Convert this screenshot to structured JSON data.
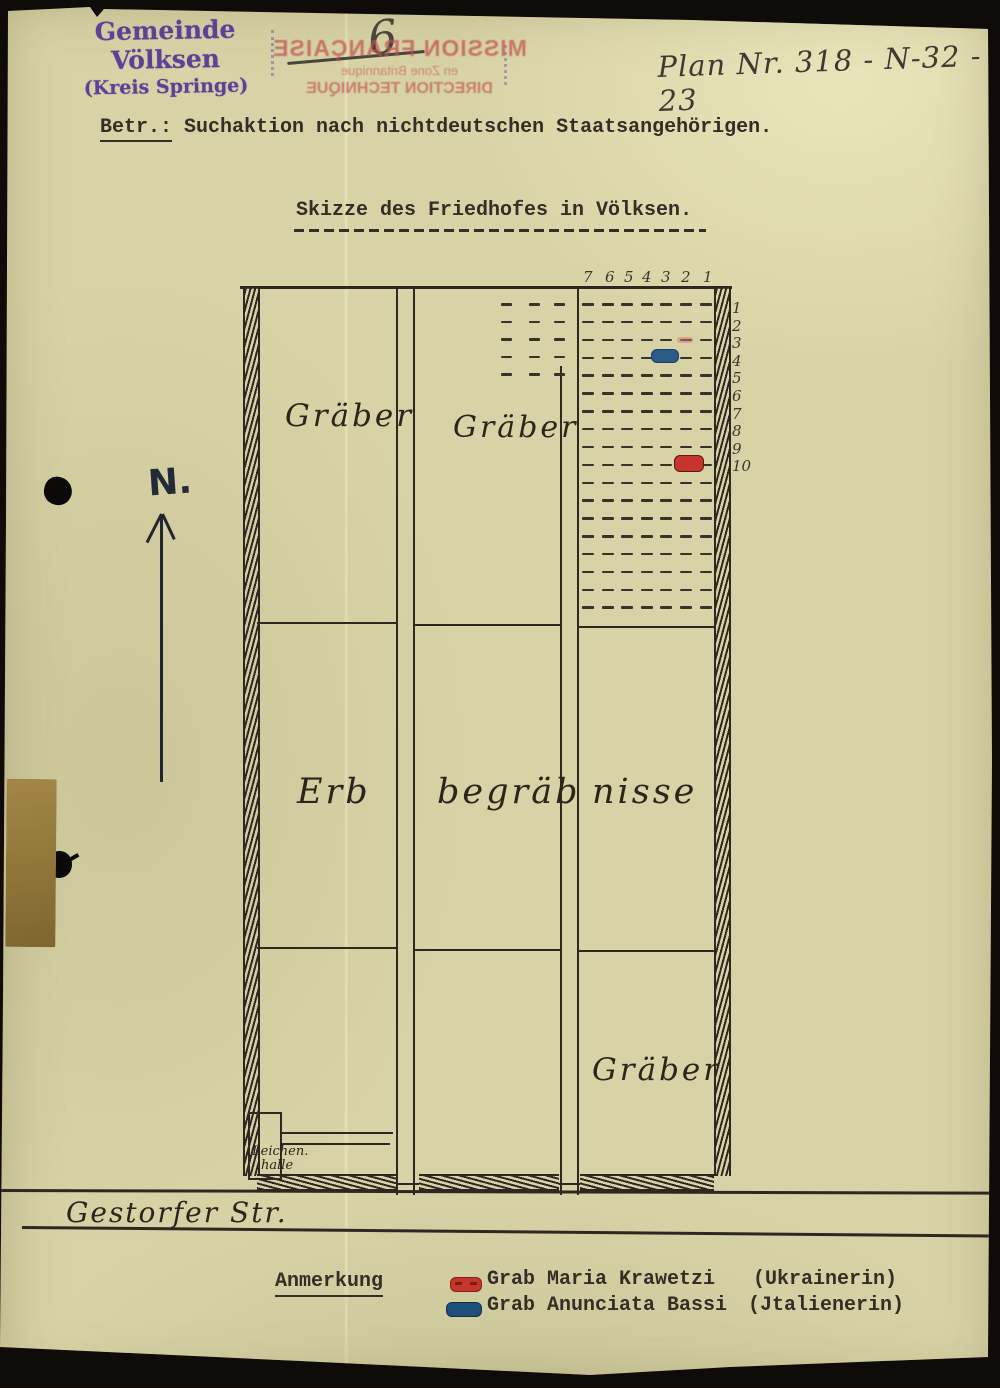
{
  "header": {
    "municipality_stamp": {
      "line1": "Gemeinde Völksen",
      "line2": "(Kreis Springe)"
    },
    "page_number": "6",
    "plan_number": "Plan Nr. 318 - N-32 - 23",
    "bleedthrough_stamp": {
      "line1": "MISSION FRANÇAISE",
      "line2": "en Zone Britannique",
      "line3": "DIRECTION TECHNIQUE"
    },
    "subject_label": "Betr.:",
    "subject_text": "Suchaktion nach nichtdeutschen Staatsangehörigen.",
    "title": "Skizze des Friedhofes in Völksen."
  },
  "map": {
    "north_label": "N.",
    "section_labels": {
      "graves_nw": "Gräber",
      "graves_n_center": "Gräber",
      "family_plots_1": "Erb",
      "family_plots_2": "begräb",
      "family_plots_3": "nisse",
      "graves_se": "Gräber"
    },
    "mortuary": {
      "line1": "Leichen.",
      "line2": "halle"
    },
    "street": "Gestorfer Str.",
    "grid": {
      "column_numbers": [
        "7",
        "6",
        "5",
        "4",
        "3",
        "2",
        "1"
      ],
      "col_num_x": [
        583,
        605,
        624,
        642,
        661,
        681,
        703
      ],
      "col_num_y": 268,
      "row_numbers": [
        "1",
        "2",
        "3",
        "4",
        "5",
        "6",
        "7",
        "8",
        "9",
        "10"
      ],
      "row_num_x": 732,
      "row_num_y0": 299,
      "row_num_dy": 17.6,
      "main": {
        "x0": 582,
        "dx": 19.6,
        "cols": 7,
        "y0": 303,
        "dy": 17.85,
        "rows": 18,
        "dash_w": 12
      },
      "west": {
        "x_list": [
          501,
          529,
          554
        ],
        "y0": 303,
        "dy": 17.5,
        "rows": 5,
        "dash_w": 11
      }
    },
    "marks": [
      {
        "name": "grave-mark-red",
        "grave": "Grab Maria Krawetzi",
        "row": "10",
        "column": "2",
        "x": 674,
        "y": 455,
        "w": 28,
        "h": 15,
        "color": "#c5352b",
        "border": "#5f1511"
      },
      {
        "name": "grave-mark-blue",
        "grave": "Grab Anunciata Bassi",
        "row": "4",
        "column": "3",
        "x": 651,
        "y": 349,
        "w": 26,
        "h": 12,
        "color": "#2b5a88",
        "border": "#1d3f63"
      },
      {
        "name": "grave-mark-faint",
        "grave": "",
        "row": "3",
        "column": "2",
        "x": 677,
        "y": 337,
        "w": 14,
        "h": 4,
        "color": "rgba(210,115,115,0.5)",
        "border": "rgba(210,115,115,0)"
      }
    ]
  },
  "legend": {
    "heading": "Anmerkung",
    "items": [
      {
        "symbol_color": "#c5352b",
        "symbol_border": "#5f1511",
        "text": "Grab Maria Krawetzi",
        "nationality": "(Ukrainerin)"
      },
      {
        "symbol_color": "#1f4e78",
        "symbol_border": "#0f2f4e",
        "text": "Grab Anunciata Bassi",
        "nationality": "(Jtalienerin)"
      }
    ]
  },
  "colors": {
    "paper": "#d7d3a6",
    "ink": "#2d2822",
    "stamp_purple": "#5c4197",
    "bleed_red": "#c45052",
    "north_ink": "#232b3a"
  }
}
